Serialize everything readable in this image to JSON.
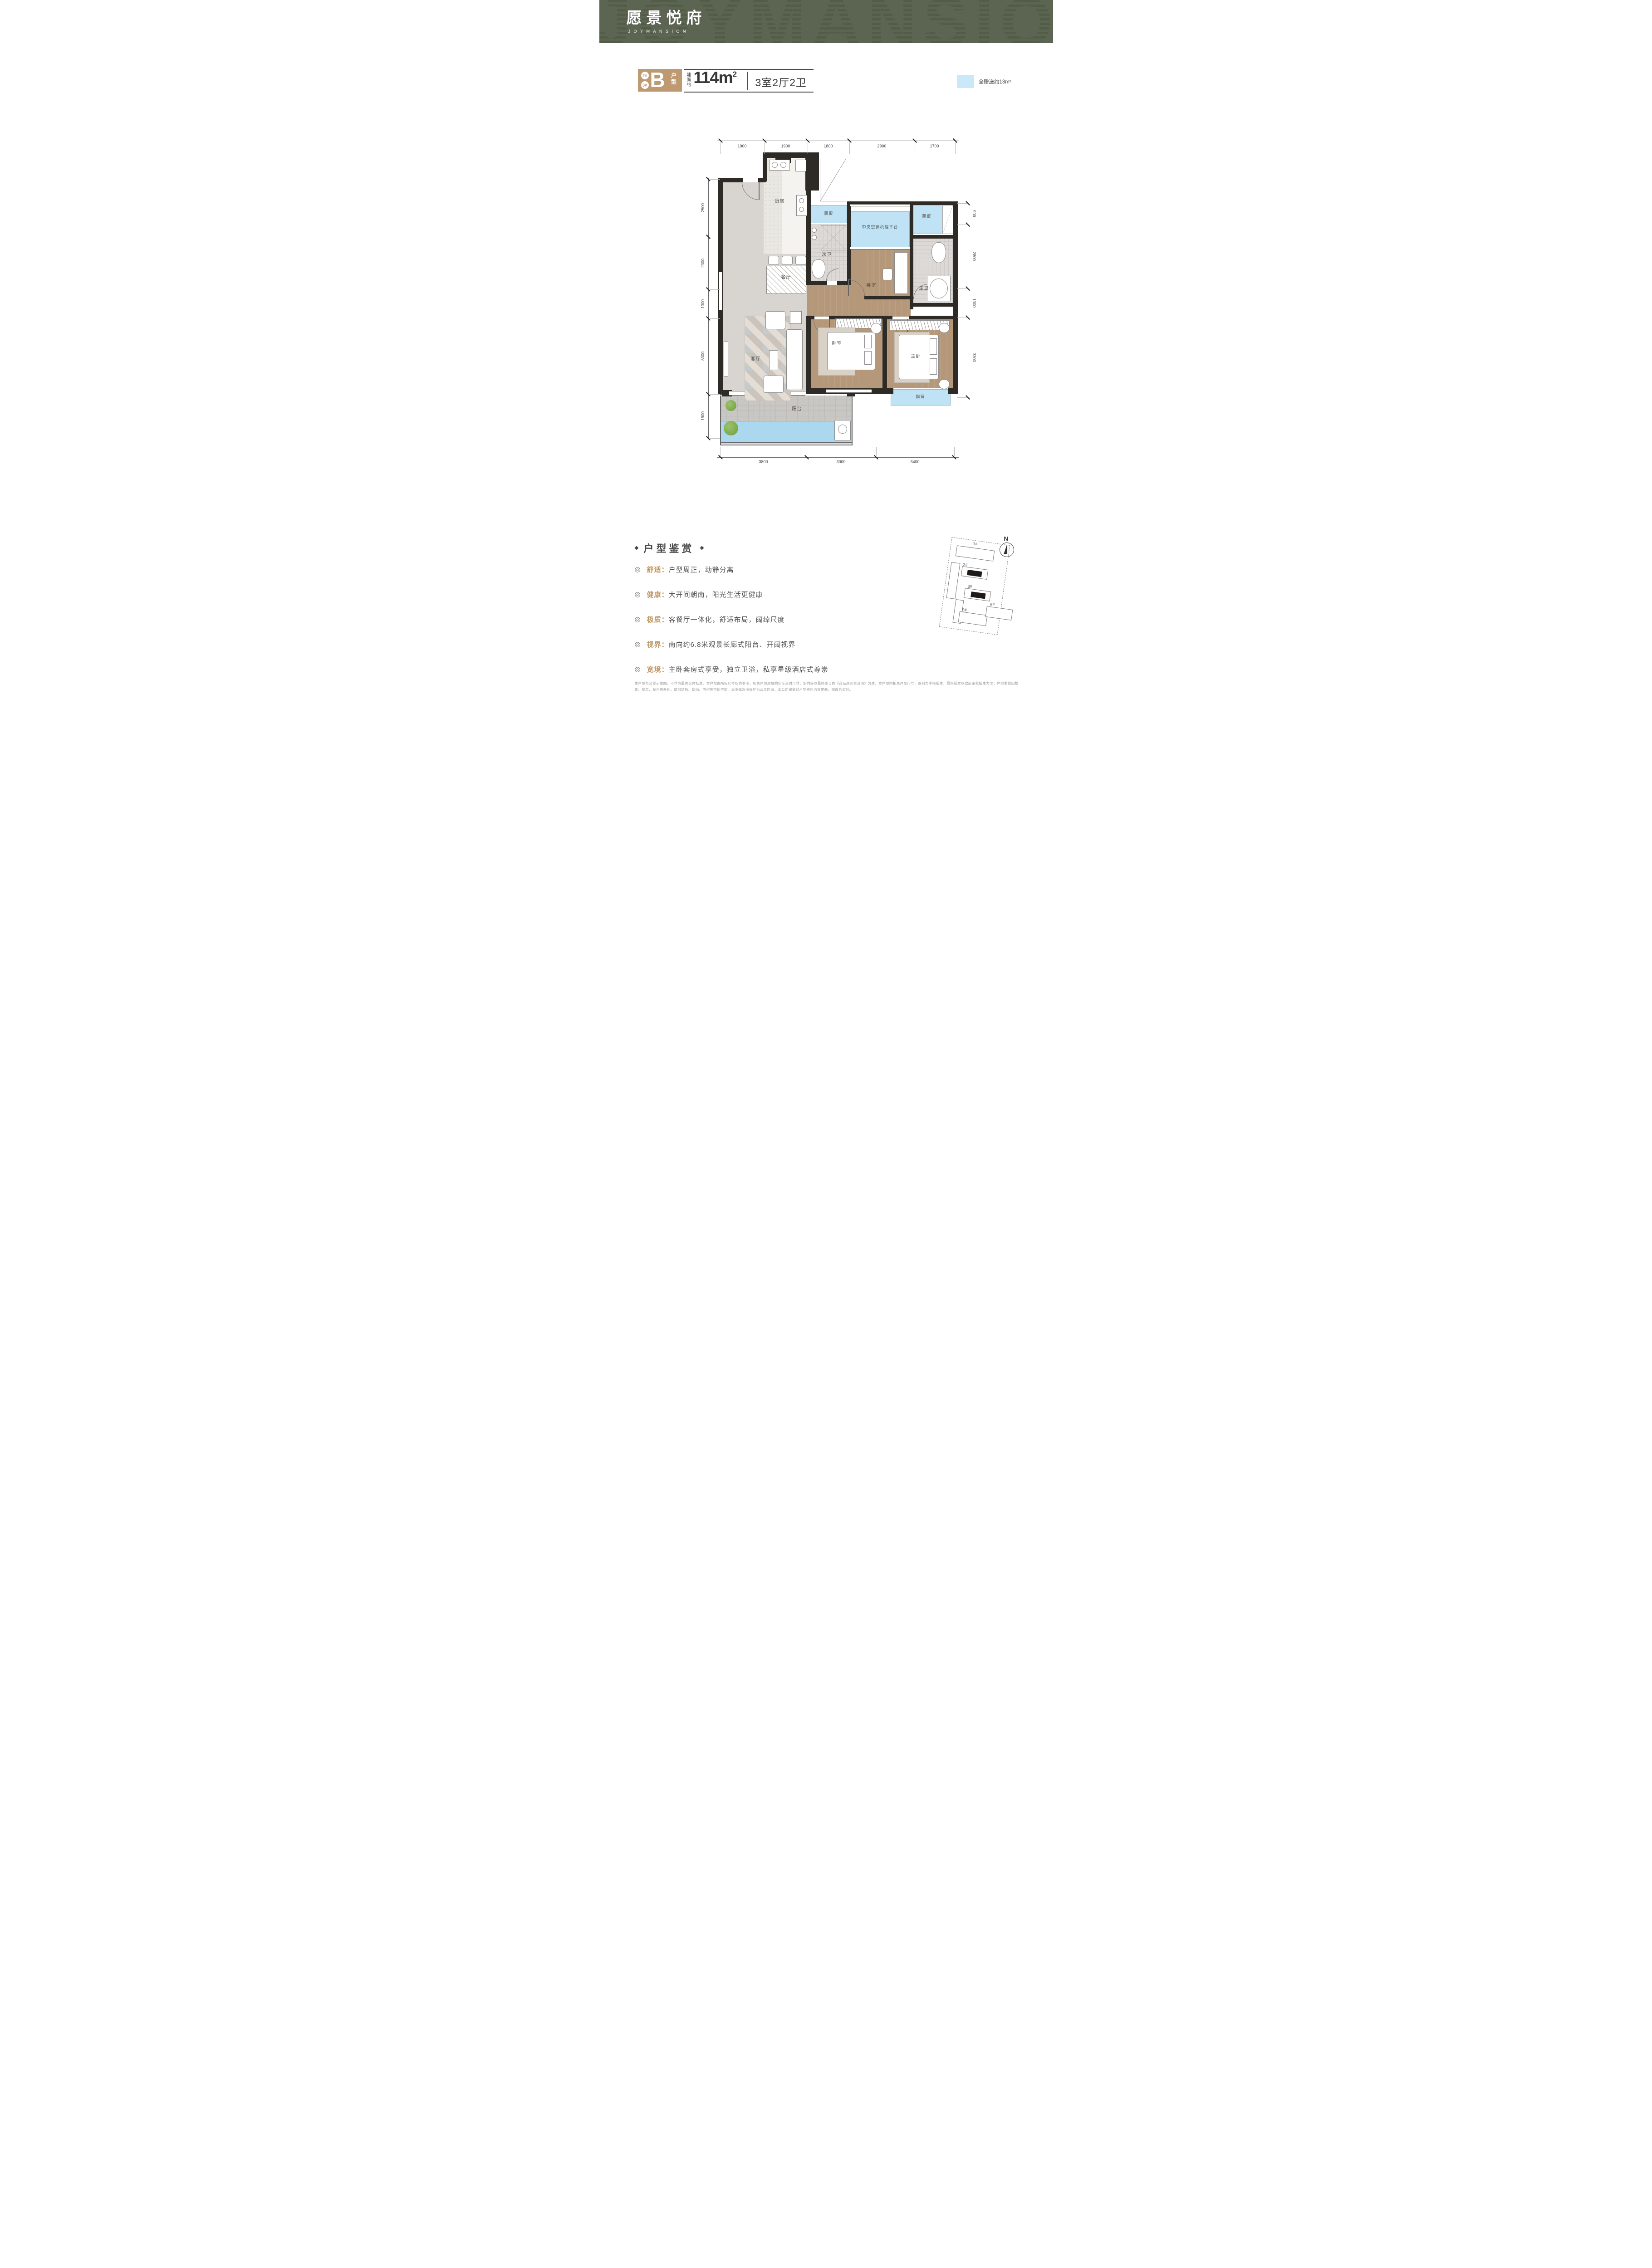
{
  "header": {
    "logo_cn": "愿景悦府",
    "logo_en": "JOYMANSION",
    "watermark": "JOYMANSION"
  },
  "unit": {
    "buildings": [
      "2#",
      "3#"
    ],
    "type_letter": "B",
    "type_label": "户型",
    "area_prefix": "建面约",
    "area_value": "114m",
    "area_sup": "2",
    "rooms": "3室2厅2卫"
  },
  "legend": {
    "gift": "全赠送约13m²"
  },
  "plan": {
    "rooms": {
      "kitchen": "厨房",
      "dining": "餐厅",
      "living": "客厅",
      "balcony": "阳台",
      "bath2": "次卫",
      "bath1": "主卫",
      "bed_mid": "卧室",
      "bed2": "卧室",
      "master": "主卧",
      "ac": "中央空调机组平台",
      "bay1": "飘窗",
      "bay2": "飘窗",
      "bay3": "飘窗"
    },
    "dims": {
      "top": [
        "1900",
        "1900",
        "1800",
        "2900",
        "1700"
      ],
      "bottom": [
        "3800",
        "3000",
        "3400"
      ],
      "left": [
        "2500",
        "2300",
        "1300",
        "3300",
        "1900"
      ],
      "right": [
        "900",
        "2800",
        "1300",
        "3300"
      ]
    }
  },
  "features": {
    "title": "户型鉴赏",
    "bullet": "◎",
    "items": [
      {
        "label": "舒适：",
        "text": "户型周正，动静分离"
      },
      {
        "label": "健康：",
        "text": "大开间朝南，阳光生活更健康"
      },
      {
        "label": "极质：",
        "text": "客餐厅一体化，舒适布局，阔绰尺度"
      },
      {
        "label": "视界：",
        "text": "南向约6.8米观景长廊式阳台、开阔视界"
      },
      {
        "label": "宽境：",
        "text": "主卧套房式享受，独立卫浴，私享星级酒店式尊崇"
      }
    ]
  },
  "siteplan": {
    "north": "N",
    "b1": "1#",
    "b2": "2#",
    "b3": "3#",
    "b5": "5#",
    "b6": "6#"
  },
  "disclaimer": "本户型为装修示意图，不作为最终交付标准。本户型图所标尺寸仅供参考，相关户型房屋的实际交付尺寸、朝向等以最终签订的《商品房买卖合同》为准。本户型内相关户型尺寸、图例为申报版本，最终版本以政府审批版本为准；户型单位因楼栋、楼层、单元等差别，局部结构、朝向、面积等可能不同。本电梯及电梯厅为公共区域。本公司保留对户型资料内容更新、修改的权利。",
  "colors": {
    "header_bg": "#5c6452",
    "accent_tan": "#bd9a72",
    "gift_blue": "#bfe3f4",
    "gold_text": "#bd9560"
  }
}
